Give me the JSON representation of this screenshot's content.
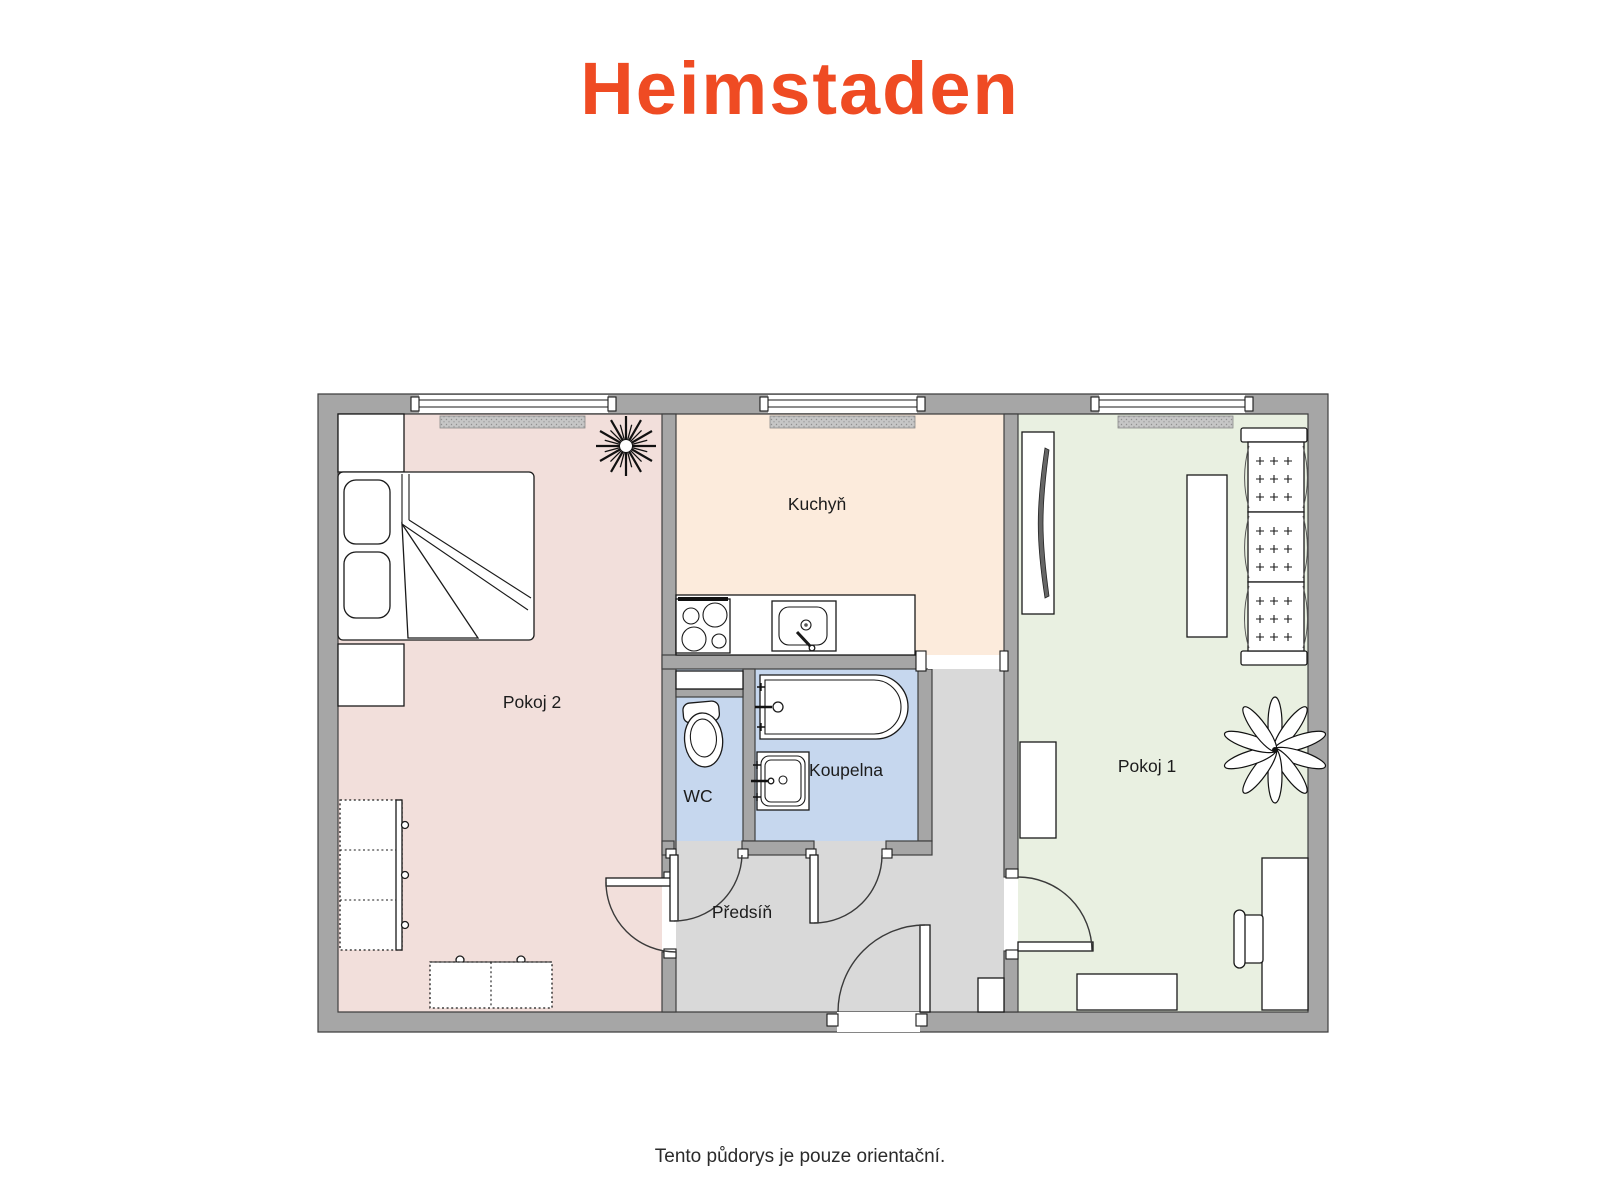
{
  "logo": {
    "text": "Heimstaden",
    "color": "#EF4B23"
  },
  "floorplan": {
    "wall_color": "#A6A6A6",
    "hatch_color": "#C6C6C6",
    "rooms": [
      {
        "id": "pokoj-2",
        "label": "Pokoj 2",
        "color": "#F2DFDB"
      },
      {
        "id": "kuchyn",
        "label": "Kuchyň",
        "color": "#FCEBDC"
      },
      {
        "id": "pokoj-1",
        "label": "Pokoj 1",
        "color": "#E9F0E1"
      },
      {
        "id": "wc",
        "label": "WC",
        "color": "#C6D7EE"
      },
      {
        "id": "koupelna",
        "label": "Koupelna",
        "color": "#C6D7EE"
      },
      {
        "id": "predsin",
        "label": "Předsíň",
        "color": "#D9D9D9"
      }
    ]
  },
  "footer": {
    "note": "Tento půdorys je pouze orientační."
  }
}
